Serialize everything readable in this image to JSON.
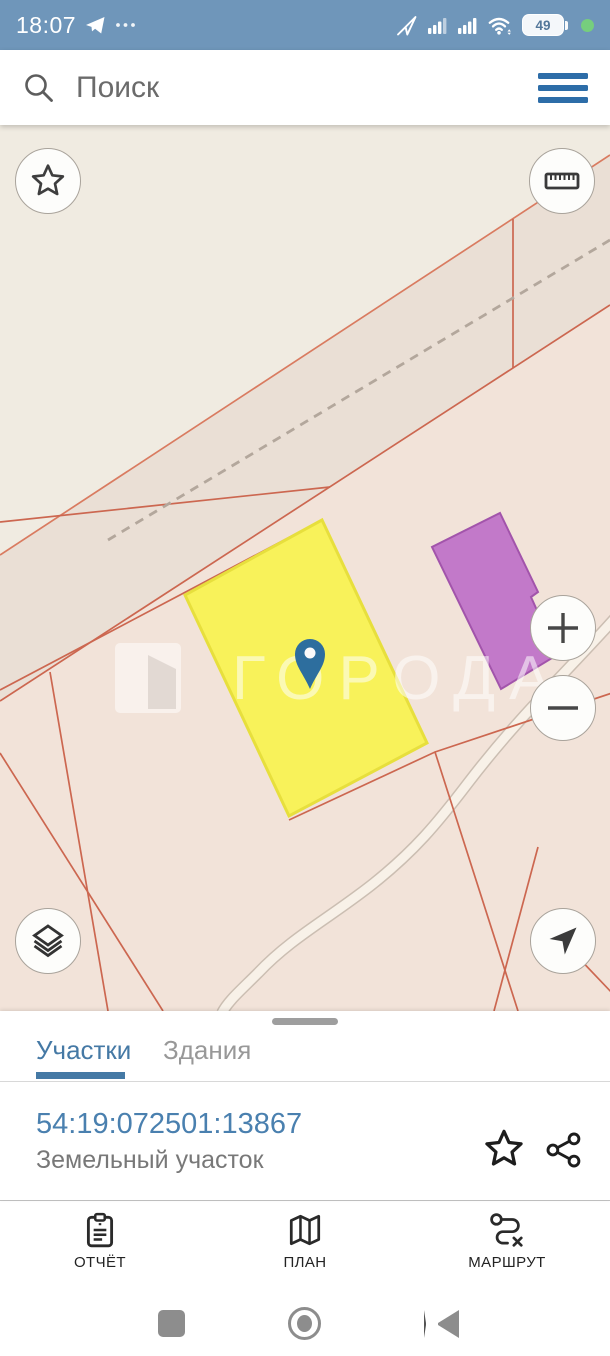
{
  "status_bar": {
    "time": "18:07",
    "battery_percent": "49"
  },
  "search": {
    "placeholder": "Поиск"
  },
  "map": {
    "watermark": "ГОРОДА",
    "selected_parcel_fill": "#f8f25a",
    "building_parcel_fill": "#c279c9"
  },
  "sheet": {
    "tabs": [
      {
        "label": "Участки",
        "active": true
      },
      {
        "label": "Здания",
        "active": false
      }
    ],
    "parcel": {
      "cadastral_number": "54:19:072501:13867",
      "type_label": "Земельный участок"
    }
  },
  "bottom_nav": {
    "items": [
      {
        "label": "ОТЧЁТ",
        "icon": "report-clipboard"
      },
      {
        "label": "ПЛАН",
        "icon": "folded-map"
      },
      {
        "label": "МАРШРУТ",
        "icon": "route-path"
      }
    ]
  },
  "icons": {
    "search": "magnifier",
    "menu": "hamburger",
    "favorites": "star-outline",
    "measure": "ruler",
    "zoom_in": "plus",
    "zoom_out": "minus",
    "layers": "stacked-layers",
    "locate": "navigation-arrow",
    "favorite_parcel": "star-outline",
    "share": "share-nodes",
    "android": [
      "recents-square",
      "home-circle",
      "back-triangle"
    ]
  },
  "colors": {
    "c-statusbar": "#6f96ba",
    "c-accent": "#2d6da8",
    "c-link": "#4a80af",
    "c-tab": "#4579a5",
    "c-map-beige": "#f0ebe1",
    "c-map-strip": "#eadfd5",
    "c-map-pink": "#f2e3d9",
    "c-line": "#cc6750",
    "c-line-light": "#d97b60",
    "c-yellow": "#f8f25a",
    "c-yellow-b": "#e7df3d",
    "c-purple": "#c279c9",
    "c-purple-b": "#a254ab",
    "c-pin": "#2d6e9e",
    "c-text-dark": "#232323",
    "c-text-gray": "#787878",
    "c-navicon": "#8d8d8d",
    "c-handle": "#9e9e9e"
  }
}
